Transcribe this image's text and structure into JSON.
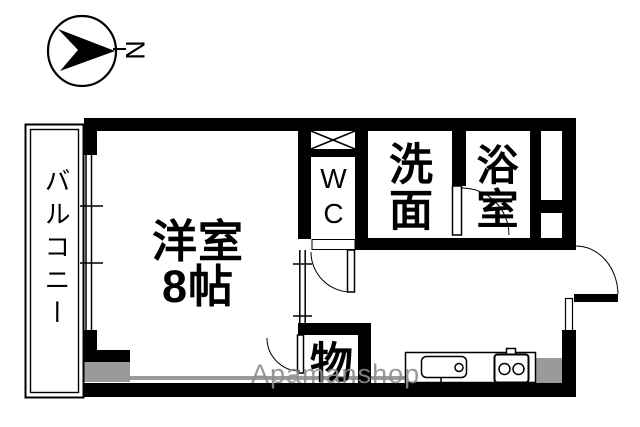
{
  "compass": {
    "north_label": "N"
  },
  "rooms": {
    "balcony_label": "バルコニー",
    "main_room_label": "洋室",
    "main_room_size": "8帖",
    "wc_label": "WC",
    "washroom_label": "洗面",
    "bathroom_label": "浴室",
    "storage_label": "物"
  },
  "watermark_text": "Apamanshop",
  "colors": {
    "wall": "#000000",
    "shade": "#9a9a9a",
    "watermark": "#8d8d8d"
  }
}
